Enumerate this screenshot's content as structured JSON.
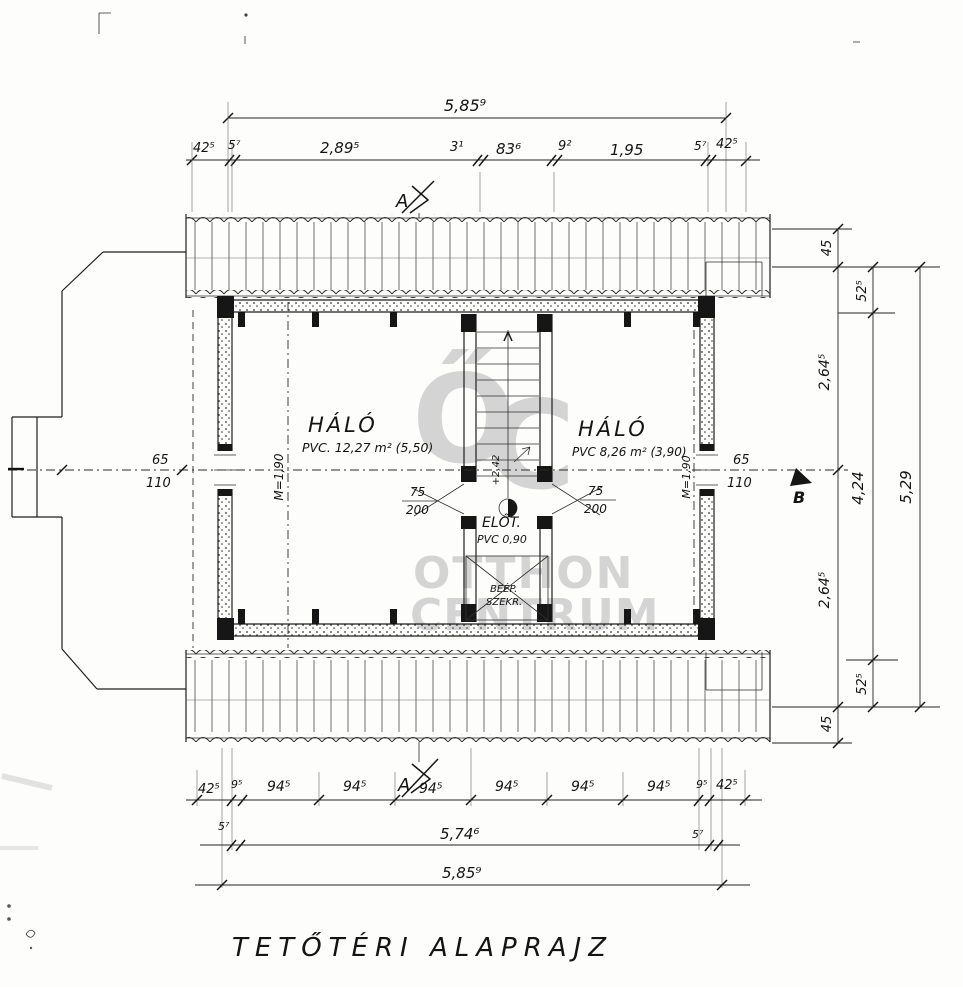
{
  "title": "TETŐTÉRI ALAPRAJZ",
  "watermark": {
    "logo_o": "Ő",
    "logo_c": "C",
    "line1": "OTTHON",
    "line2": "CENTRUM"
  },
  "markers": {
    "section_a": "A",
    "section_b": "B"
  },
  "dims": {
    "top_total": "5,85⁹",
    "top": [
      "42⁵",
      "5⁷",
      "2,89⁵",
      "3¹",
      "83⁶",
      "9²",
      "1,95",
      "5⁷",
      "42⁵"
    ],
    "right_inner": [
      "45",
      "2,64⁵",
      "2,64⁵",
      "45"
    ],
    "right_mid": [
      "52⁵",
      "4,24",
      "52⁵"
    ],
    "right_total": "5,29",
    "bottom_row1": [
      "42⁵",
      "9⁵",
      "94⁵",
      "94⁵",
      "94⁵",
      "94⁵",
      "94⁵",
      "94⁵",
      "9⁵",
      "42⁵"
    ],
    "bottom_row2": [
      "5⁷",
      "5,74⁶",
      "5⁷"
    ],
    "bottom_total": "5,85⁹"
  },
  "rooms": {
    "bedroom_left": {
      "name": "HÁLÓ",
      "info": "PVC. 12,27 m² (5,50)"
    },
    "bedroom_right": {
      "name": "HÁLÓ",
      "info": "PVC 8,26 m² (3,90)"
    },
    "hall": {
      "name": "ELŐT.",
      "info": "PVC 0,90"
    },
    "wardrobe": {
      "line1": "BEÉP.",
      "line2": "SZEKR."
    }
  },
  "openings": {
    "window_left": {
      "num": "65",
      "den": "110"
    },
    "window_right": {
      "num": "65",
      "den": "110"
    },
    "door_left": {
      "num": "75",
      "den": "200"
    },
    "door_right": {
      "num": "75",
      "den": "200"
    }
  },
  "annotations": {
    "left_height": "M=1,90",
    "right_height": "M=1,90",
    "stair_level": "+2,42"
  }
}
